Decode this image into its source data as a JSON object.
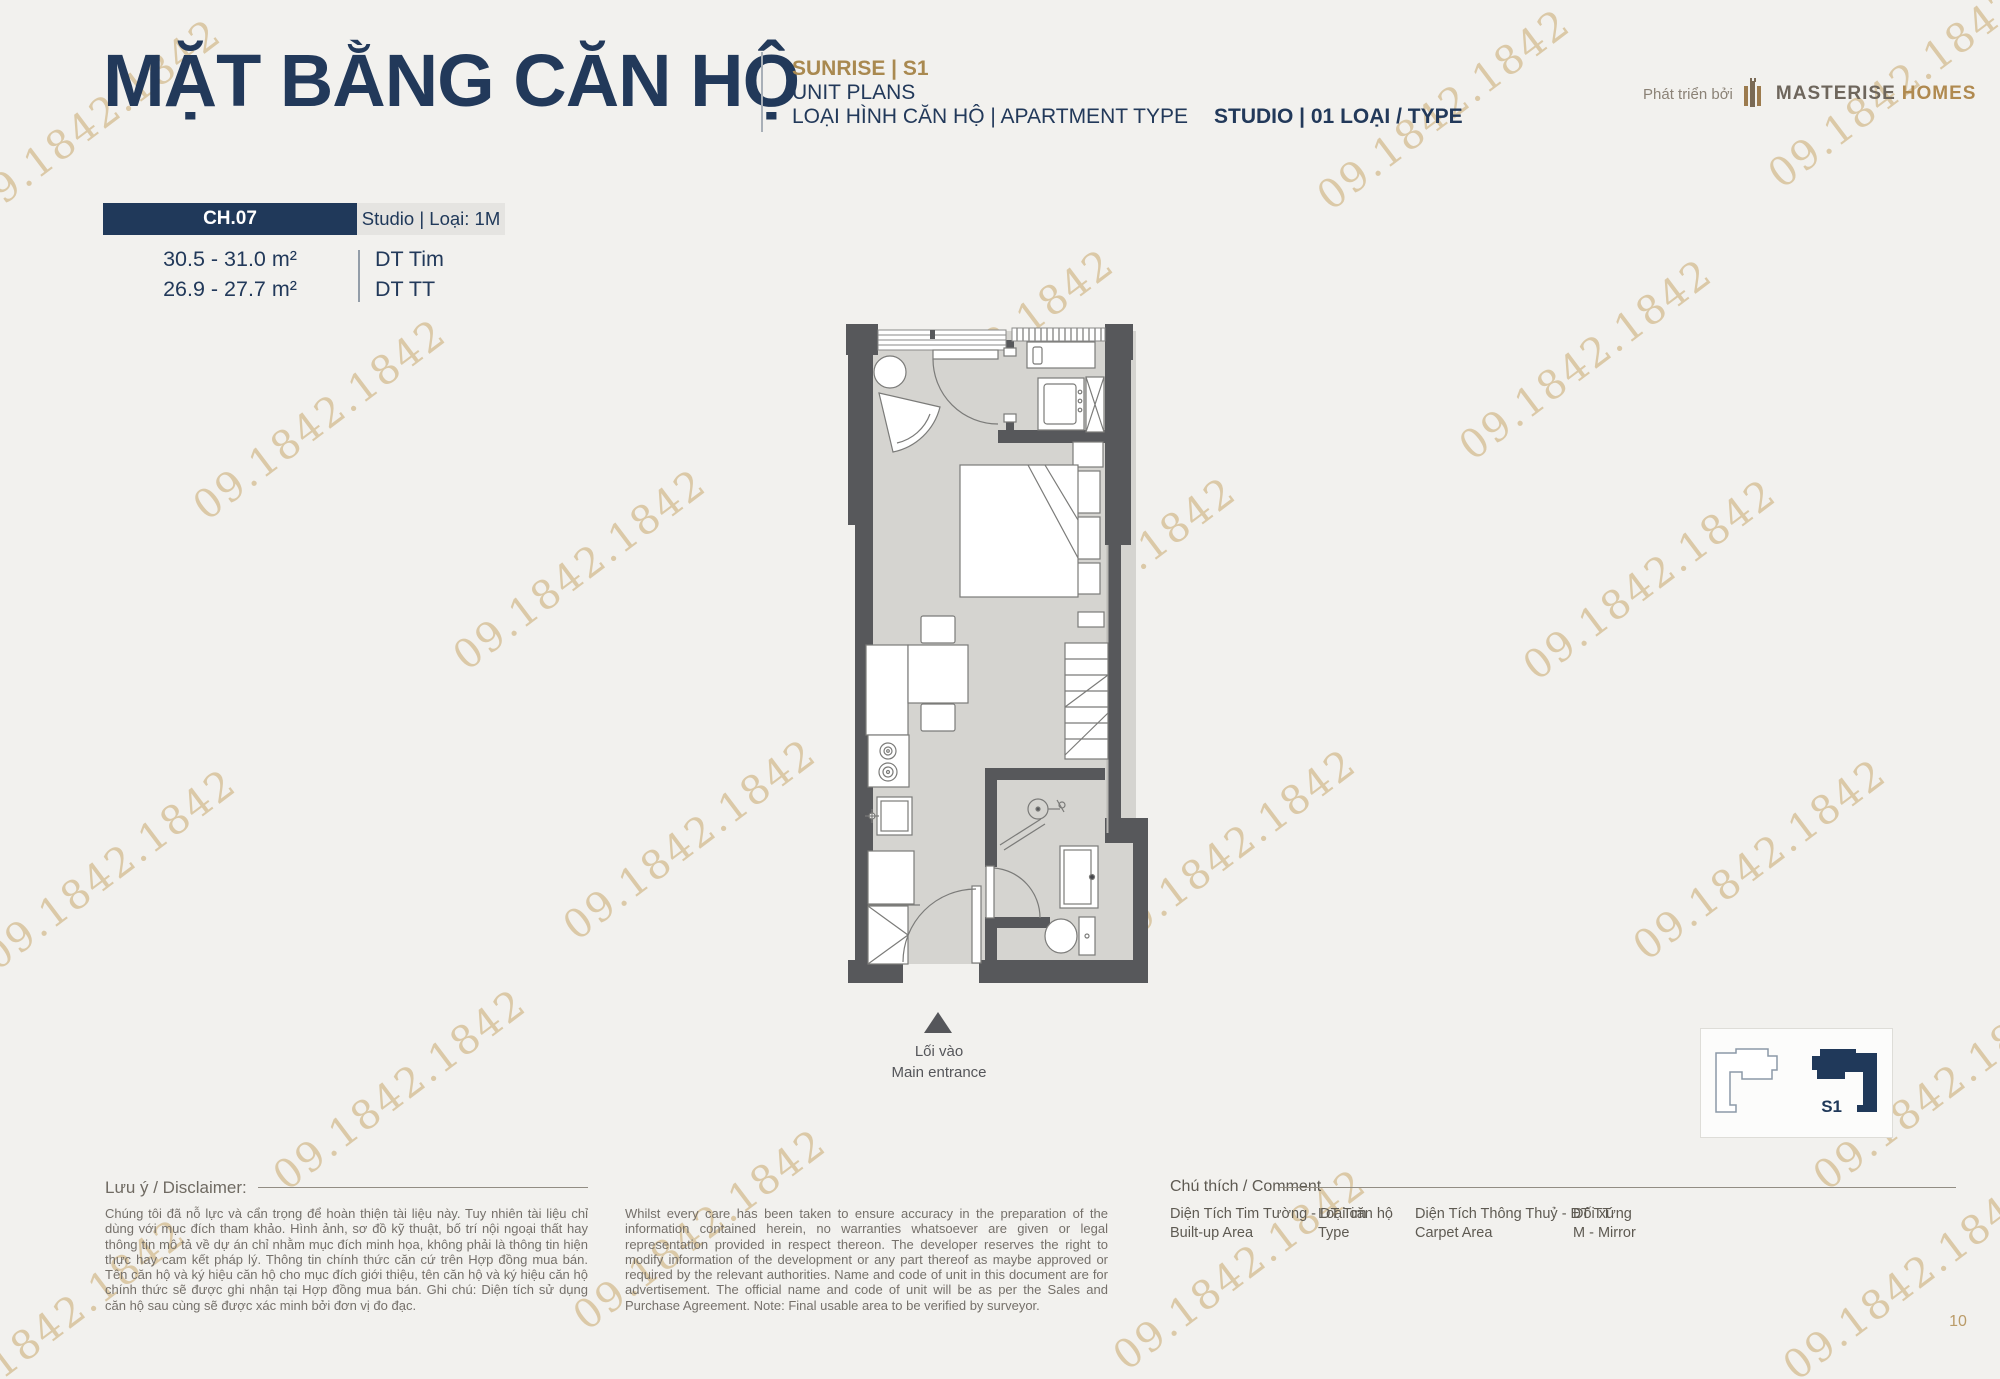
{
  "watermark": {
    "text": "09.1842.1842"
  },
  "header": {
    "title": "MẶT BẰNG CĂN HỘ",
    "project": "SUNRISE  |  S1",
    "subtitle": "UNIT PLANS",
    "type_label": "LOẠI HÌNH CĂN HỘ  |  APARTMENT TYPE",
    "type_value": "STUDIO  |  01 LOẠI / TYPE",
    "developer_prefix": "Phát triển bởi",
    "developer_name": "MASTERISE",
    "developer_name2": "HOMES"
  },
  "unit": {
    "code": "CH.07",
    "type": "Studio | Loại: 1M",
    "areas": [
      {
        "value": "30.5 - 31.0 m²",
        "label": "DT Tim"
      },
      {
        "value": "26.9 - 27.7 m²",
        "label": "DT TT"
      }
    ]
  },
  "plan": {
    "entrance_vi": "Lối vào",
    "entrance_en": "Main entrance",
    "keyplan_label": "S1"
  },
  "disclaimer": {
    "title": "Lưu ý / Disclaimer:",
    "vi": "Chúng tôi đã nỗ lực và cẩn trọng để hoàn thiện tài liệu này. Tuy nhiên tài liệu chỉ dùng với mục đích tham khảo. Hình ảnh, sơ đồ kỹ thuật, bố trí nội ngoại thất hay thông tin mô tả về dự án chỉ nhằm mục đích minh họa, không phải là thông tin hiện thực hay cam kết pháp lý. Thông tin chính thức căn cứ trên Hợp đồng mua bán. Tên căn hộ và ký hiệu căn hộ cho mục đích giới thiệu, tên căn hộ và ký hiệu căn hộ chính thức sẽ được ghi nhận tại Hợp đồng mua bán. Ghi chú: Diện tích sử dụng căn hộ sau cùng sẽ được xác minh bởi đơn vị đo đạc.",
    "en": "Whilst every care has been taken to ensure accuracy in the preparation of the information contained herein, no warranties whatsoever are given or legal representation provided in respect thereon. The developer reserves the right to modify information of the development or any part thereof as maybe approved or required by the relevant authorities. Name and code of unit in this document are for advertisement. The official name and code of unit will be as per the Sales and Purchase Agreement. Note: Final usable area to be verified by surveyor."
  },
  "legend": {
    "title": "Chú thích / Comment",
    "items": [
      {
        "vi": "Diện Tích Tim Tường - DT Tim",
        "en": "Built-up Area"
      },
      {
        "vi": "Loại căn hộ",
        "en": "Type"
      },
      {
        "vi": "Diện Tích Thông Thuỷ - DT TT",
        "en": "Carpet Area"
      },
      {
        "vi": "Đối xứng",
        "en": "M - Mirror"
      }
    ]
  },
  "page": {
    "number": "10"
  },
  "colors": {
    "navy": "#20395a",
    "gold": "#ab8a55",
    "watermark": "#c9a86e",
    "wall": "#57585b",
    "floor": "#d5d4d0"
  }
}
